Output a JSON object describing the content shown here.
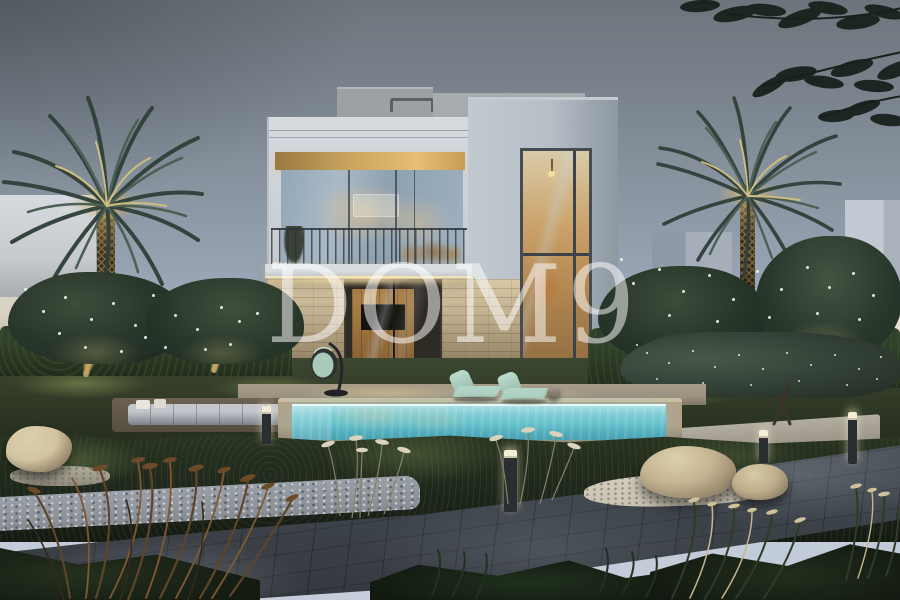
{
  "watermark": {
    "text": "DOM9",
    "tm": "™",
    "color": "#ffffff",
    "opacity": "0.52"
  },
  "palette": {
    "sky_top": "#6d747c",
    "sky_mid": "#96a2b1",
    "sky_low": "#bfc9d6",
    "house_light": "#d6dbe0",
    "house_mid": "#c3c9d0",
    "tower_face": "#b6bec6",
    "tower_shade": "#8e98a2",
    "soffit_wood": "#d9ae67",
    "interior_warm": "#e0b271",
    "interior_deep": "#8f6c42",
    "glass_cool": "#9aadbd",
    "stone_light": "#d8c8a6",
    "stone_dark": "#665a48",
    "led_warm": "#f6e7bd",
    "pool_light": "#aadee4",
    "pool_mid": "#64bfca",
    "pool_deep": "#479fb0",
    "coping": "#b1a38a",
    "deck": "#9b9180",
    "lounger_mint": "#a9cfc0",
    "sofa_gray": "#a8adb4",
    "lawn_lit": "#5d6a40",
    "hedge_dark": "#232d1d",
    "garden_dark": "#1b231a",
    "path_dark": "#34393f",
    "path_mid": "#4e545b",
    "gravel": "#979ba2",
    "white_gravel": "#cac3b3",
    "rock_light": "#d4c5a2",
    "rock_dark": "#6e6250",
    "palm_dark": "#31403a",
    "palm_mid": "#4c5f54",
    "palm_lit": "#c9b97d",
    "trunk_lit": "#a38750",
    "wall_cream": "#d9d3c4",
    "bollard_glow": "#f4eed7",
    "flower_white": "#eceee4",
    "branch_dark": "#18201c"
  }
}
